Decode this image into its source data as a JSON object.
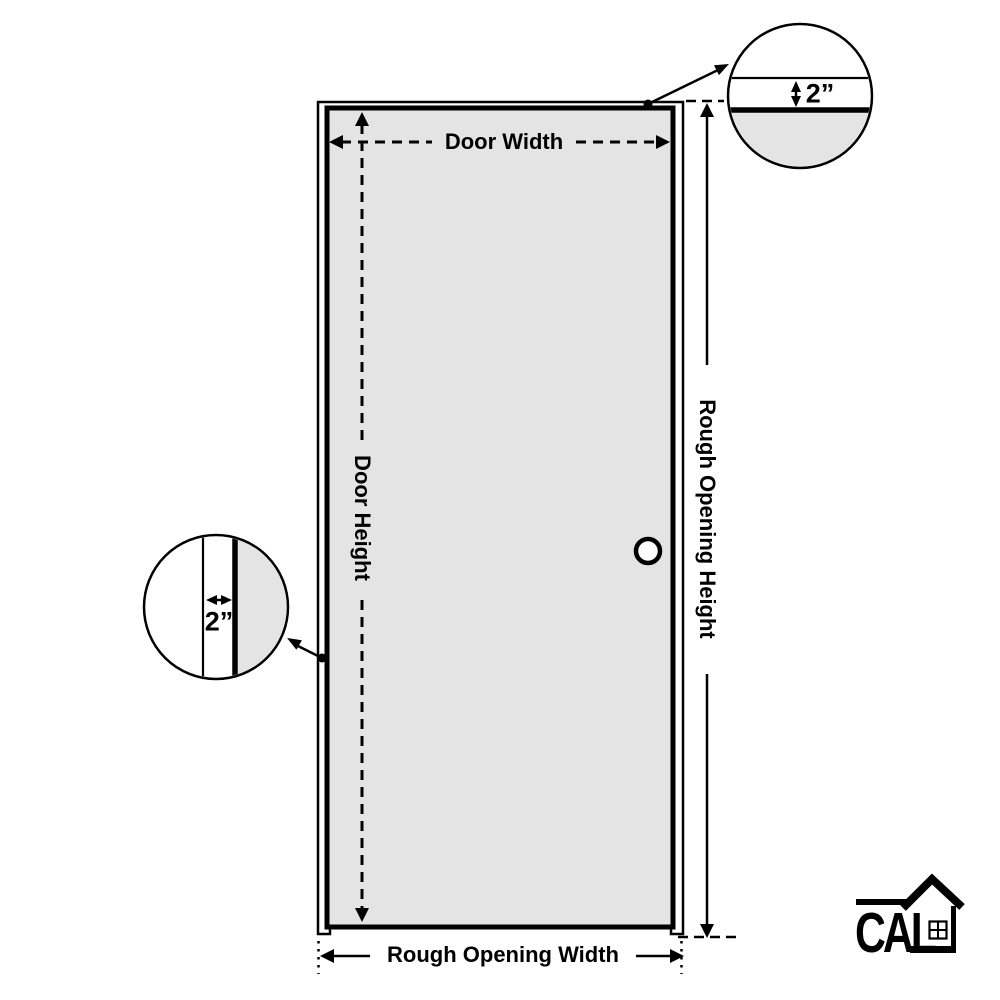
{
  "diagram": {
    "labels": {
      "door_width": "Door Width",
      "door_height": "Door Height",
      "rough_opening_width": "Rough Opening Width",
      "rough_opening_height": "Rough Opening Height"
    },
    "callouts": {
      "head_jamb": {
        "value": "2”"
      },
      "side_jamb": {
        "value": "2”"
      }
    },
    "colors": {
      "line": "#000000",
      "door_fill": "#e4e4e4",
      "background": "#ffffff"
    }
  },
  "logo": {
    "text": "CAL"
  }
}
